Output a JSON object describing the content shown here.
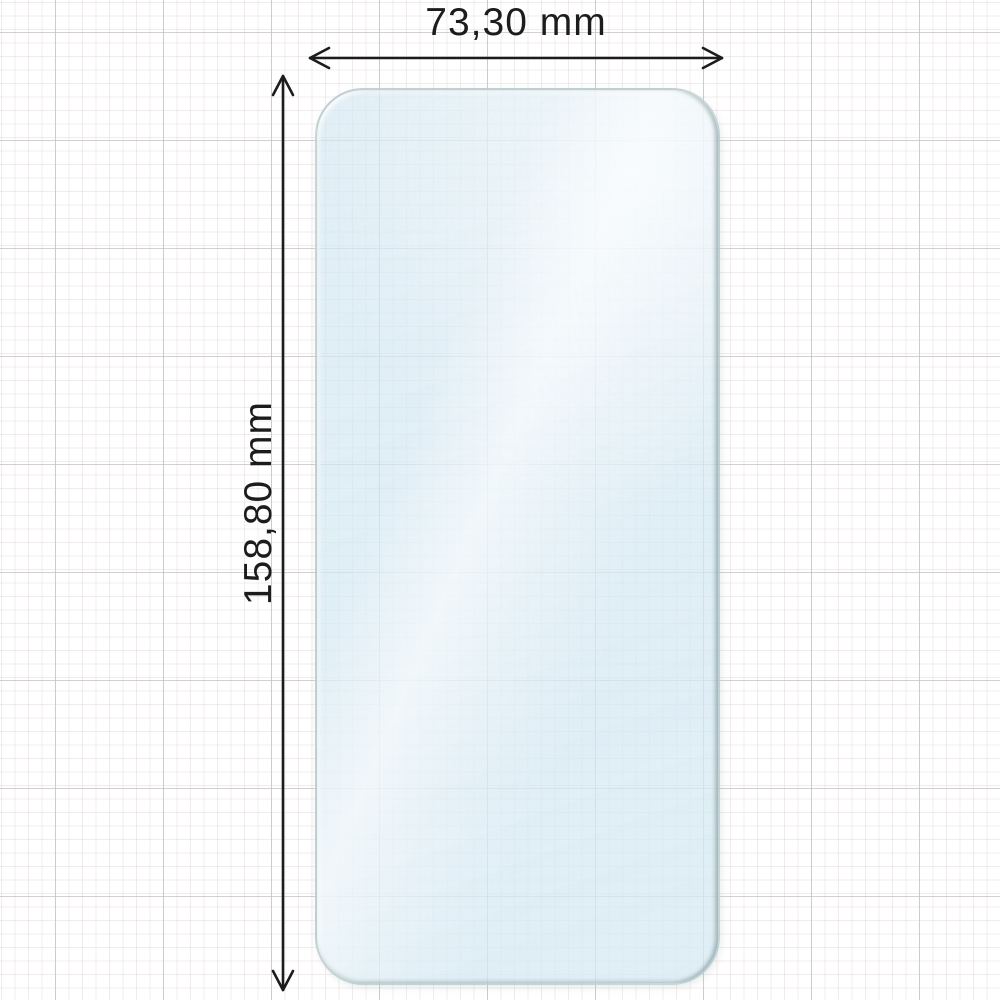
{
  "diagram": {
    "title": "Screen protector dimensions",
    "object_name": "screen-protector-film",
    "width_dimension": "73,30 mm",
    "height_dimension": "158,80 mm"
  },
  "colors": {
    "background": "#ffffff",
    "grid_fine_line": "#ded6d6",
    "grid_major_line": "#c6c0c0",
    "film_tint": "#d5e8f2",
    "film_edge": "#8fa3a3",
    "arrow_stroke": "#1c1c1c",
    "label_text": "#1c1c1c"
  }
}
